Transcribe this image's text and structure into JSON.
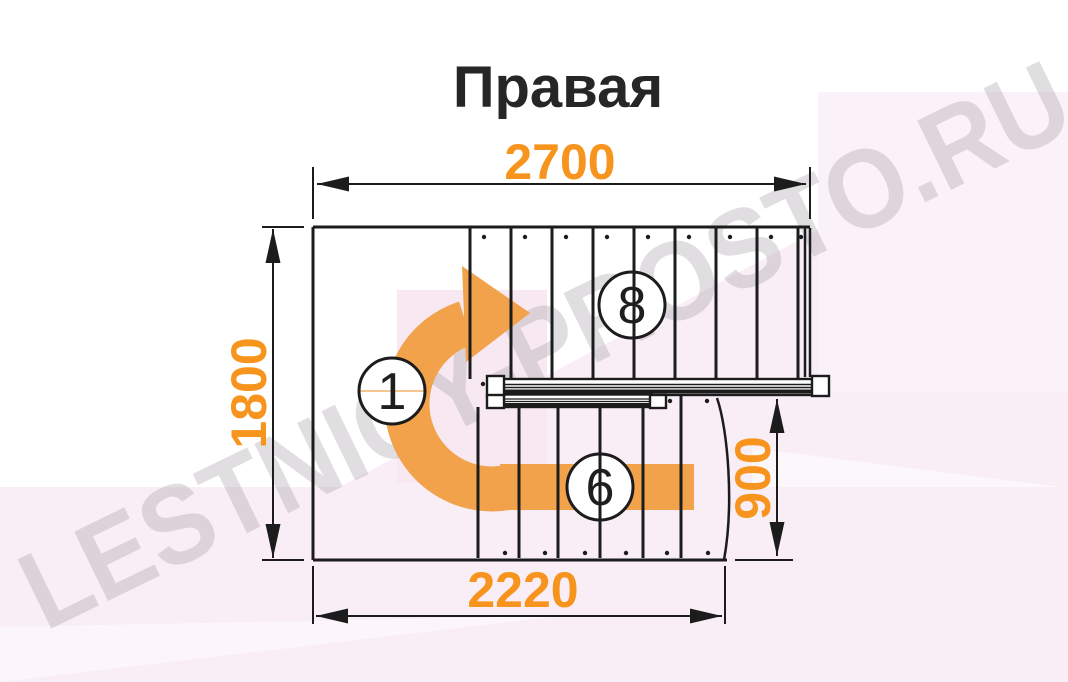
{
  "title": "Правая",
  "watermark": {
    "text": "LESTNICY-PROSTO.RU"
  },
  "diagram": {
    "type": "staircase-plan-top-view",
    "dimensions_mm": {
      "total_length": "2700",
      "total_width": "1800",
      "lower_run_length": "2220",
      "exit_width": "900"
    },
    "step_markers": {
      "first_step": "1",
      "upper_flight_steps": "8",
      "lower_flight_steps": "6"
    }
  },
  "colors": {
    "dimension_text": "#F7941D",
    "arrow_orange": "#F2A24B",
    "outline_black": "#1C1C1C",
    "background_tint": "#F9EEF6",
    "watermark_gray": "#A7A0A7"
  }
}
